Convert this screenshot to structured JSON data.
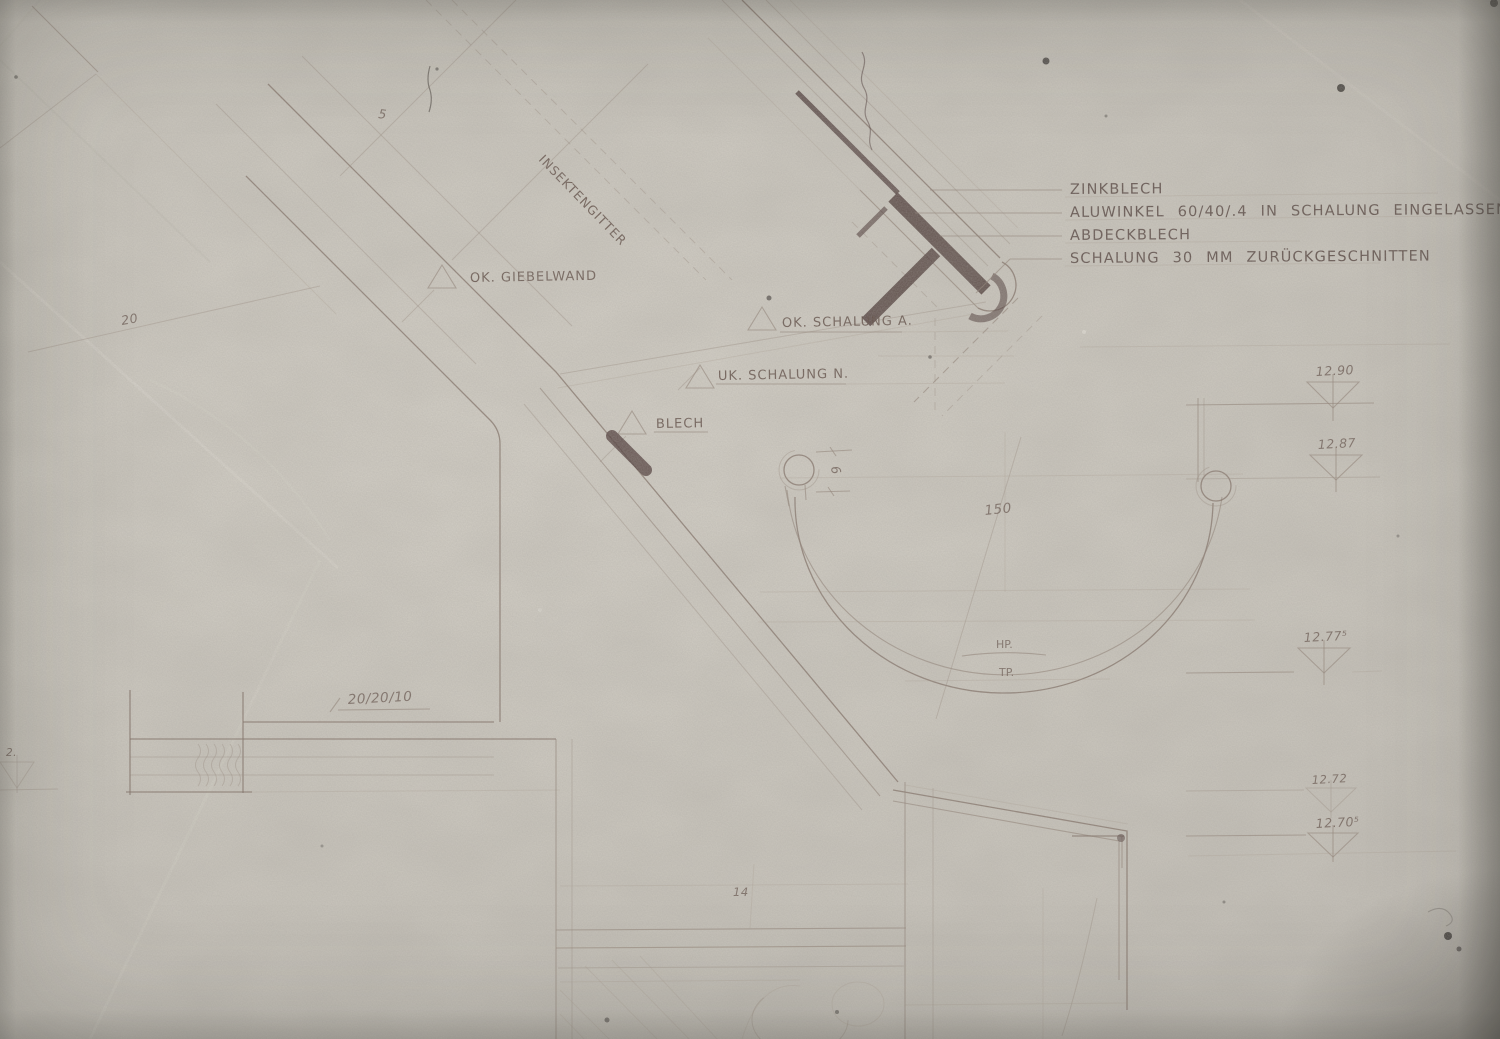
{
  "palette": {
    "paper": "#cdc9c0",
    "pencil_faint": "#9c8d80",
    "pencil": "#8d7d71",
    "pencil_strong": "#6a574e",
    "detail_dark": "#4a3634",
    "lettering": "#564540"
  },
  "callouts": {
    "zinkblech": "ZINKBLECH",
    "aluwinkel": "ALUWINKEL 60/40/.4 IN SCHALUNG EINGELASSEN",
    "abdeckblech": "ABDECKBLECH",
    "schalung_zurueck": "SCHALUNG 30 MM ZURÜCKGESCHNITTEN"
  },
  "labels": {
    "insektengitter": "INSEKTENGITTER",
    "ok_giebelwand": "OK. GIEBELWAND",
    "ok_schalung": "OK. SCHALUNG A.",
    "uk_schalung": "UK. SCHALUNG N.",
    "blech": "BLECH",
    "hp": "HP.",
    "tp": "TP."
  },
  "dimensions": {
    "batten": "20/20/10",
    "gutter_width": "150",
    "dim5": "5",
    "dim20": "20",
    "dim6": "6",
    "dim14": "14"
  },
  "elevations": {
    "e1": "12.90",
    "e2": "12.87",
    "e3": "12.77⁵",
    "e4": "12.72",
    "e5": "12.70⁵",
    "edge_left": "2."
  }
}
